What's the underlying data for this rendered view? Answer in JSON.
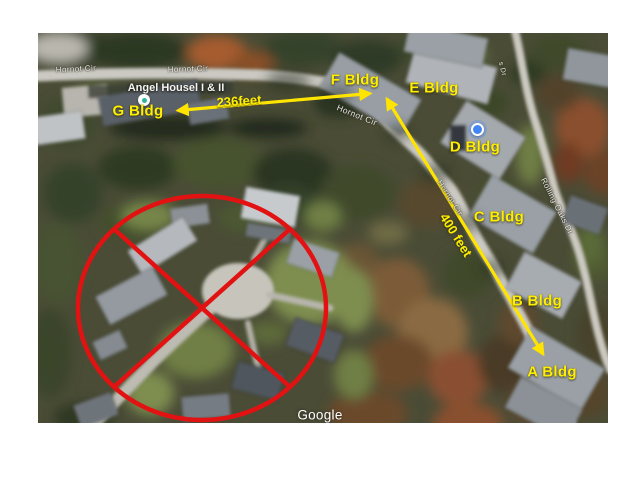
{
  "figure": {
    "watermark": "Google",
    "place": {
      "name": "Angel Housel I & II"
    },
    "roads": {
      "hornot_cir_a": "Hornot Cir",
      "hornot_cir_b": "Hornot Cir",
      "hornot_cir_c": "Hornot Cir",
      "hornot_cir_d": "Hornot Cir",
      "rolling_oaks": "Rolling Oaks Dr",
      "side_dr": "s Dr"
    },
    "buildings": {
      "a": "A Bldg",
      "b": "B Bldg",
      "c": "C Bldg",
      "d": "D Bldg",
      "e": "E Bldg",
      "f": "F Bldg",
      "g": "G Bldg"
    },
    "measurements": {
      "g_to_f": "236feet",
      "f_to_a": "400 feet"
    },
    "colors": {
      "annotation_yellow": "#ffee00",
      "prohibited_red": "#e31212",
      "location_dot_blue": "#4285f4",
      "place_marker_teal": "#2db3a0"
    }
  }
}
